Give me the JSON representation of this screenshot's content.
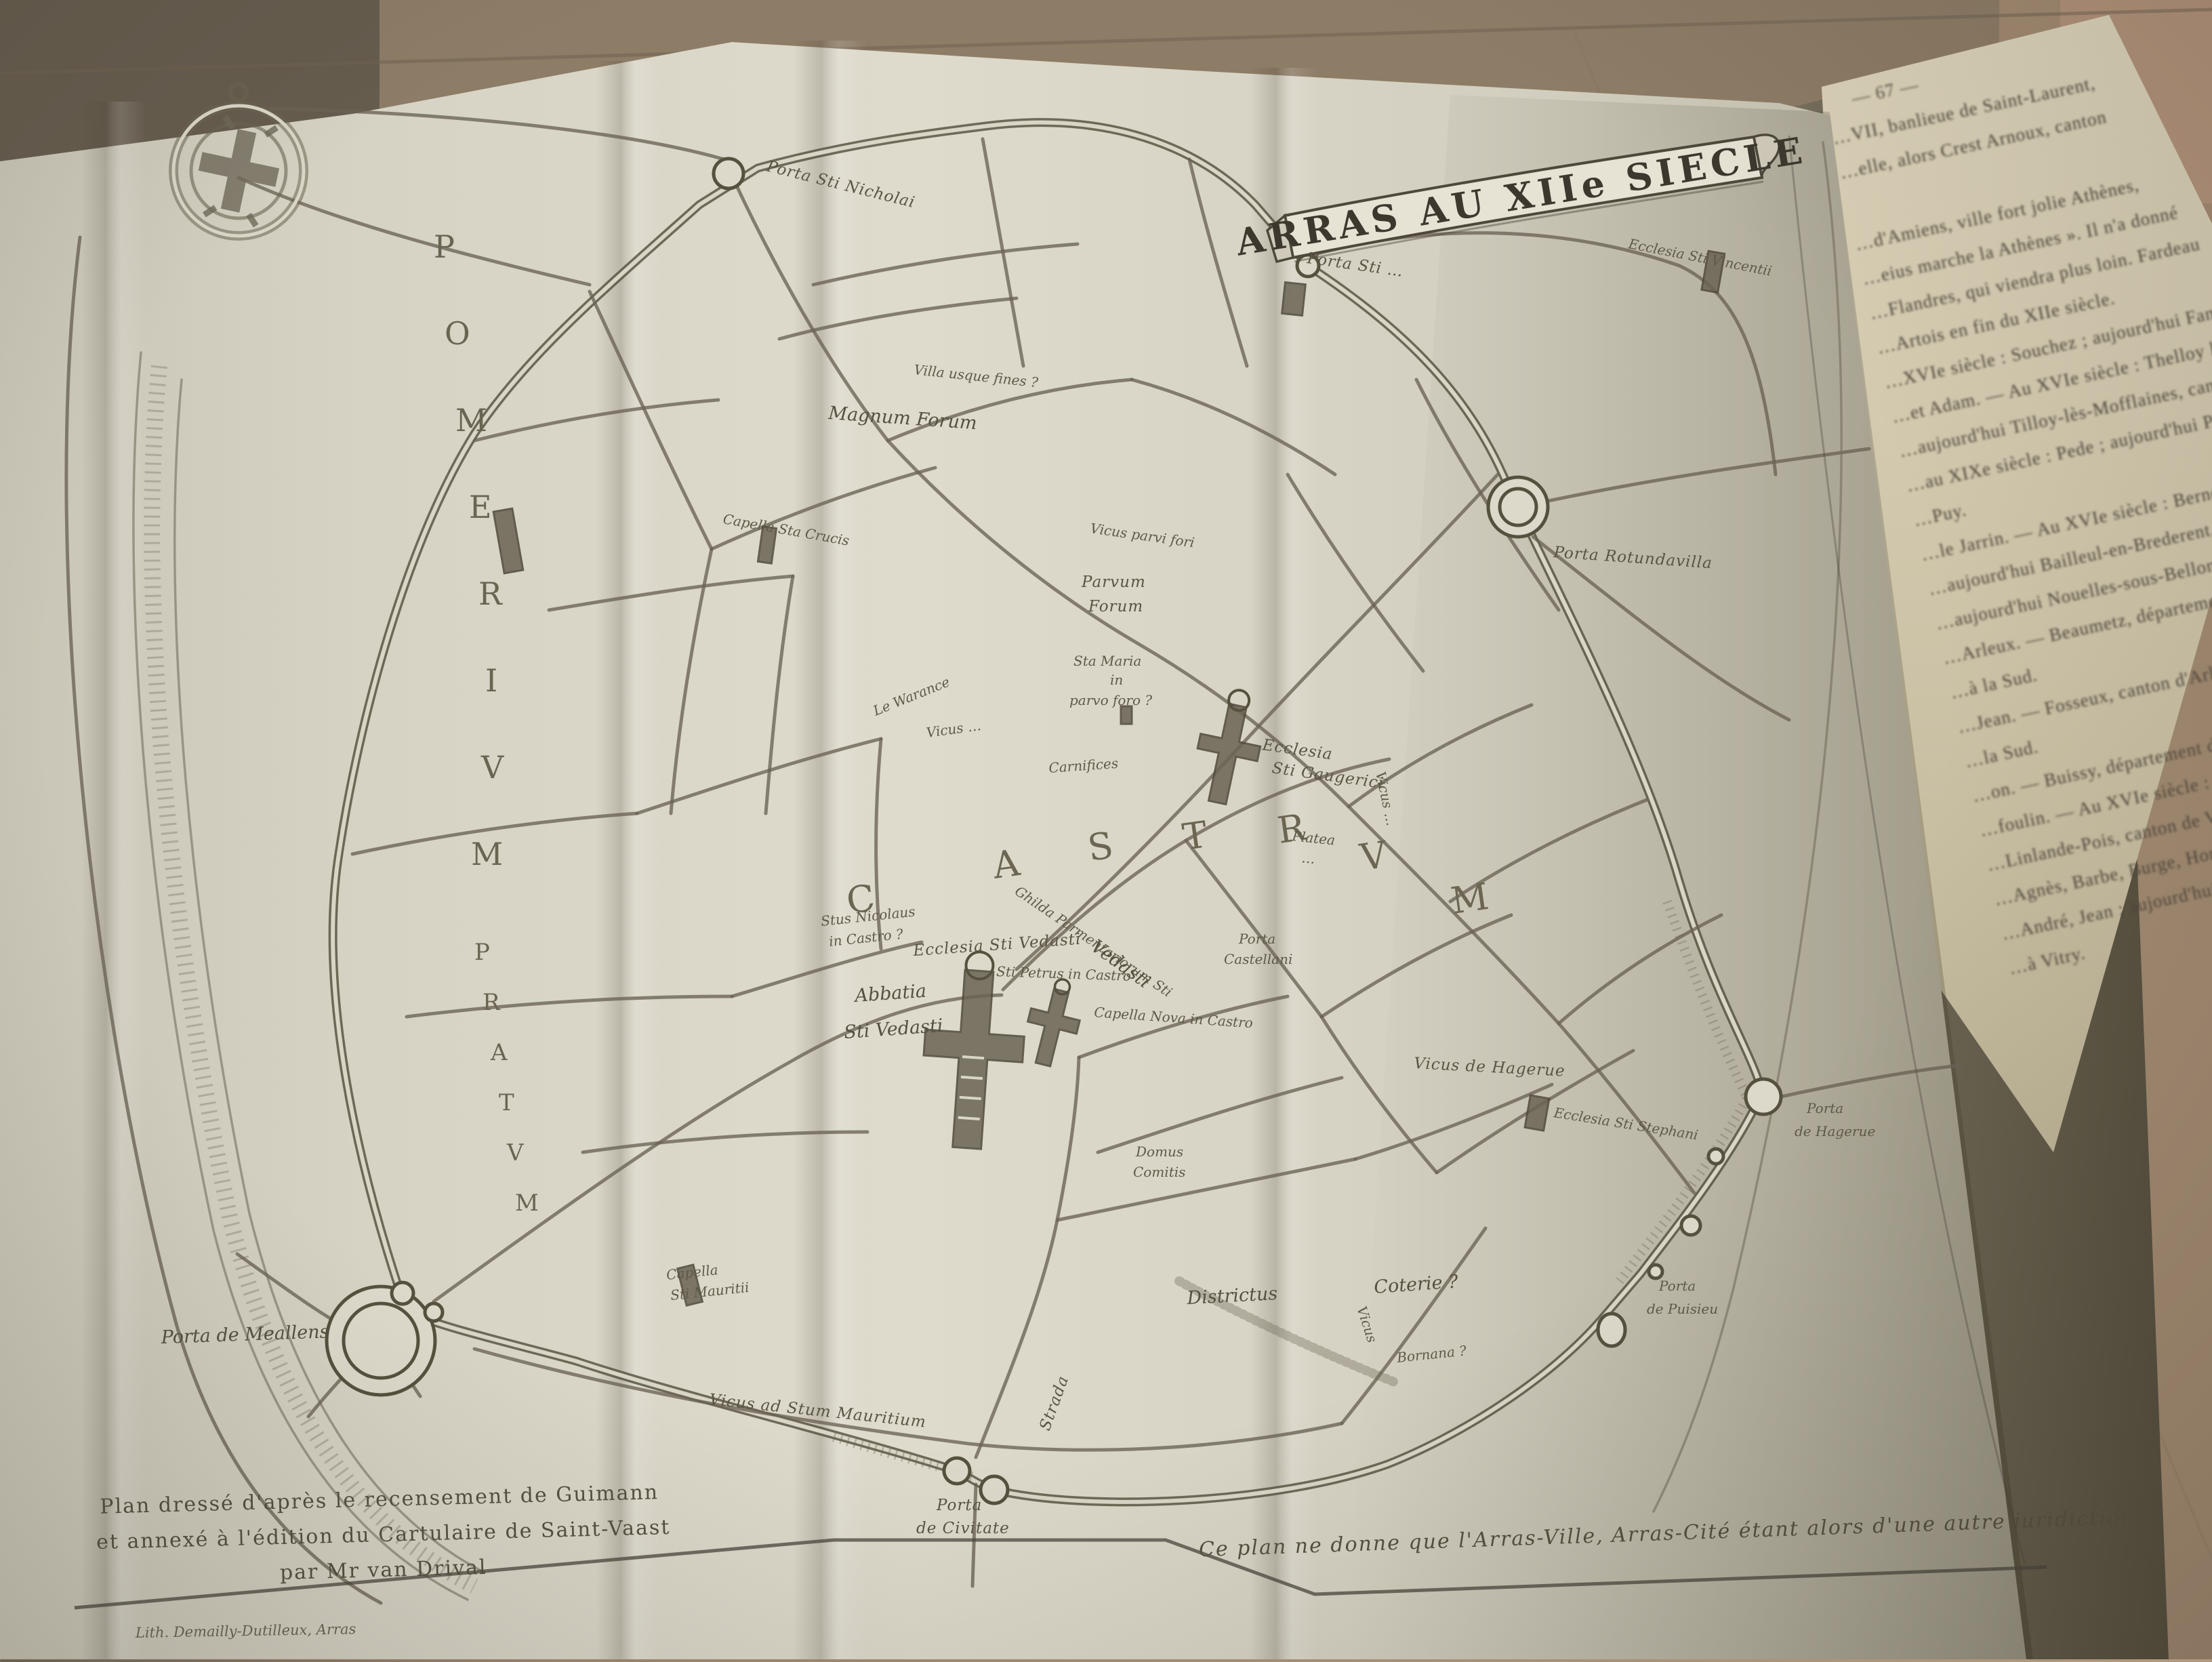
{
  "map": {
    "title": "ARRAS AU XIIe SIECLE",
    "regions": {
      "pomerium": [
        "P",
        "O",
        "M",
        "E",
        "R",
        "I",
        "V",
        "M"
      ],
      "pratum": [
        "P",
        "R",
        "A",
        "T",
        "V",
        "M"
      ],
      "castrum": [
        "C",
        "A",
        "S",
        "T",
        "R",
        "V",
        "M"
      ]
    },
    "labels": {
      "porta_sti_nicholai": "Porta Sti Nicholai",
      "villa_usque": "Villa usque fines ?",
      "magnum_forum": "Magnum Forum",
      "porta_sti_top": "Porta Sti …",
      "ecclesia_vincentii": "Ecclesia Sti Vincentii",
      "porta_rotundavilla": "Porta Rotundavilla",
      "vicus_parvi_fori": "Vicus parvi fori",
      "parvum_forum_l1": "Parvum",
      "parvum_forum_l2": "Forum",
      "sta_maria_l1": "Sta Maria",
      "sta_maria_l2": "in",
      "sta_maria_l3": "parvo foro ?",
      "carnifices": "Carnifices",
      "le_warance": "Le Warance",
      "vicus_warneri": "Vicus …",
      "ecclesia_gaugerici_l1": "Ecclesia",
      "ecclesia_gaugerici_l2": "Sti Gaugerici",
      "platea_l1": "Platea",
      "platea_l2": "…",
      "s_nicolaus_l1": "Stus Nicolaus",
      "s_nicolaus_l2": "in Castro ?",
      "ecclesia_vedasti": "Ecclesia Sti Vedasti",
      "abbatia_l1": "Abbatia",
      "abbatia_l2": "Sti Vedasti",
      "sti_petrus": "Sti Petrus in Castro",
      "capella_nova": "Capella Nova in Castro",
      "ghilda_parment": "Ghilda Parmentariorum Sti",
      "vedasti_street": "Vedasti",
      "domus_comitis_l1": "Domus",
      "domus_comitis_l2": "Comitis",
      "porta_castellani_l1": "Porta",
      "porta_castellani_l2": "Castellani",
      "vicus_hagerue": "Vicus de Hagerue",
      "ecclesia_stephani": "Ecclesia Sti Stephani",
      "porta_hagerue_l1": "Porta",
      "porta_hagerue_l2": "de Hagerue",
      "porta_puisieu_l1": "Porta",
      "porta_puisieu_l2": "de Puisieu",
      "porta_meallens": "Porta de Meallens",
      "capella_mauritii_l1": "Capella",
      "capella_mauritii_l2": "Sti Mauritii",
      "vicus_mauritium": "Vicus ad Stum Mauritium",
      "strada": "Strada",
      "districtus": "Districtus",
      "coterie": "Coterie ?",
      "vicus_south": "Vicus",
      "bornana": "Bornana ?",
      "capella_crucis": "Capella Sta Crucis",
      "porta_civitate_l1": "Porta",
      "porta_civitate_l2": "de Civitate"
    },
    "captions": {
      "bottom_left_l1": "Plan dressé d'après le recensement de Guimann",
      "bottom_left_l2": "et annexé à l'édition du Cartulaire de Saint-Vaast",
      "bottom_left_l3": "par Mr van Drival",
      "imprint": "Lith. Demailly-Dutilleux, Arras",
      "bottom_right": "Ce plan ne donne que l'Arras-Ville, Arras-Cité étant alors d'une autre juridiction"
    }
  },
  "right_page": {
    "fragments": [
      "— 67 —",
      "…VII, banlieue de Saint-Laurent,",
      "…elle, alors Crest Arnoux, canton",
      "…d'Amiens, ville fort jolie Athènes,",
      "…eius marche la Athènes ». Il n'a donné",
      "…Flandres, qui viendra plus loin. Fardeau",
      "…Artois en fin du XIIe siècle.",
      "…XVIe siècle : Souchez ; aujourd'hui Fampoux,",
      "…et Adam. — Au XVIe siècle : Thelloy les",
      "…aujourd'hui Tilloy-lès-Mofflaines, canton",
      "…au XIXe siècle : Pede ; aujourd'hui Pelves,",
      "…Puy.",
      "…le Jarrin. — Au XVIe siècle : Berneval,",
      "…aujourd'hui Bailleul-en-Brederent, canton fin",
      "…aujourd'hui Nouelles-sous-Bellonne, canton",
      "…Arleux. — Beaumetz, département du Nord",
      "…à la Sud.",
      "…Jean. — Fosseux, canton d'Arleux, fin",
      "…la Sud.",
      "…on. — Buissy, département du Nord",
      "…foulin. — Au XVIe siècle : Hamblain",
      "…Linlande-Pois, canton de Vitry,",
      "…Agnès, Barbe, Burge, Honoré,",
      "…André, Jean ; aujourd'hui Biache,",
      "…à Vitry."
    ]
  },
  "colors": {
    "wood": "#9c8a72",
    "paper": "#d9d5c7",
    "ink": "#55503f",
    "page_cream": "#cfc7ad",
    "stack_dark": "#6e6754"
  }
}
